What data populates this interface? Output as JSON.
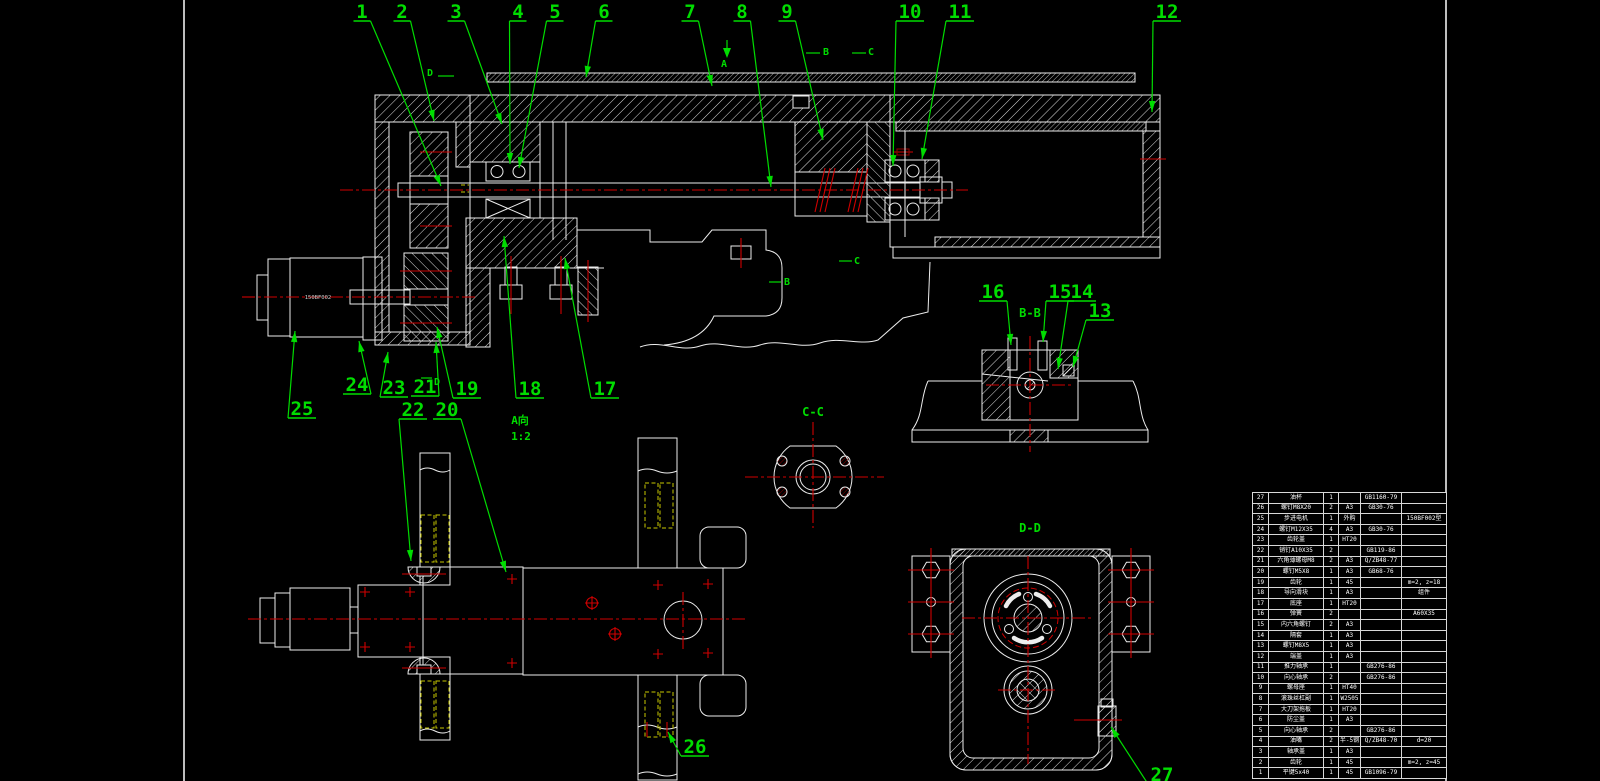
{
  "colors": {
    "background": "#000000",
    "line_white": "#ededed",
    "callout_green": "#00dd00",
    "centerline_red": "#cf0000",
    "hole_red": "#8a0000",
    "hidden_yellow": "#c9c900"
  },
  "drawing": {
    "motor_label": "150BF002",
    "view_labels": [
      {
        "id": "a-view",
        "text": "A向"
      },
      {
        "id": "a-view-scale",
        "text": "1:2"
      },
      {
        "id": "section-bb",
        "text": "B-B"
      },
      {
        "id": "section-cc",
        "text": "C-C"
      },
      {
        "id": "section-dd",
        "text": "D-D"
      }
    ],
    "section_markers": [
      {
        "text": "D"
      },
      {
        "text": "A"
      },
      {
        "text": "B"
      },
      {
        "text": "C"
      },
      {
        "text": "B"
      },
      {
        "text": "C"
      },
      {
        "text": "D"
      }
    ],
    "callouts": [
      {
        "n": "1",
        "x": 362,
        "y": 11,
        "tx": 441,
        "ty": 186
      },
      {
        "n": "2",
        "x": 402,
        "y": 11,
        "tx": 434,
        "ty": 121
      },
      {
        "n": "3",
        "x": 456,
        "y": 11,
        "tx": 502,
        "ty": 124
      },
      {
        "n": "4",
        "x": 518,
        "y": 11,
        "tx": 510,
        "ty": 164
      },
      {
        "n": "5",
        "x": 555,
        "y": 11,
        "tx": 519,
        "ty": 168
      },
      {
        "n": "6",
        "x": 604,
        "y": 11,
        "tx": 586,
        "ty": 77
      },
      {
        "n": "7",
        "x": 690,
        "y": 11,
        "tx": 712,
        "ty": 86
      },
      {
        "n": "8",
        "x": 742,
        "y": 11,
        "tx": 771,
        "ty": 187
      },
      {
        "n": "9",
        "x": 787,
        "y": 11,
        "tx": 823,
        "ty": 140
      },
      {
        "n": "10",
        "x": 910,
        "y": 11,
        "tx": 893,
        "ty": 166
      },
      {
        "n": "11",
        "x": 960,
        "y": 11,
        "tx": 922,
        "ty": 159
      },
      {
        "n": "12",
        "x": 1167,
        "y": 11,
        "tx": 1152,
        "ty": 112
      },
      {
        "n": "13",
        "x": 1100,
        "y": 310,
        "tx": 1073,
        "ty": 367
      },
      {
        "n": "14",
        "x": 1082,
        "y": 291,
        "tx": 1058,
        "ty": 369
      },
      {
        "n": "15",
        "x": 1060,
        "y": 291,
        "tx": 1043,
        "ty": 342
      },
      {
        "n": "16",
        "x": 993,
        "y": 291,
        "tx": 1011,
        "ty": 345
      },
      {
        "n": "17",
        "x": 605,
        "y": 388,
        "tx": 565,
        "ty": 258
      },
      {
        "n": "18",
        "x": 530,
        "y": 388,
        "tx": 504,
        "ty": 236
      },
      {
        "n": "19",
        "x": 467,
        "y": 388,
        "tx": 437,
        "ty": 327
      },
      {
        "n": "20",
        "x": 447,
        "y": 409,
        "tx": 506,
        "ty": 572
      },
      {
        "n": "21",
        "x": 425,
        "y": 386,
        "tx": 436,
        "ty": 342
      },
      {
        "n": "22",
        "x": 413,
        "y": 409,
        "tx": 411,
        "ty": 561
      },
      {
        "n": "23",
        "x": 394,
        "y": 387,
        "tx": 388,
        "ty": 352
      },
      {
        "n": "24",
        "x": 357,
        "y": 384,
        "tx": 359,
        "ty": 341
      },
      {
        "n": "25",
        "x": 302,
        "y": 408,
        "tx": 295,
        "ty": 331
      },
      {
        "n": "26",
        "x": 695,
        "y": 746,
        "tx": 668,
        "ty": 732
      },
      {
        "n": "27",
        "x": 1162,
        "y": 774,
        "tx": 1111,
        "ty": 727
      }
    ]
  },
  "parts_table": {
    "rows": [
      {
        "no": "27",
        "name": "油杯",
        "qty": "1",
        "mat": "",
        "std": "GB1160-79",
        "rem": ""
      },
      {
        "no": "26",
        "name": "螺钉M8X20",
        "qty": "2",
        "mat": "A3",
        "std": "GB30-76",
        "rem": ""
      },
      {
        "no": "25",
        "name": "步进电机",
        "qty": "1",
        "mat": "外购",
        "std": "",
        "rem": "150BF002型"
      },
      {
        "no": "24",
        "name": "螺钉M12X35",
        "qty": "4",
        "mat": "A3",
        "std": "GB30-76",
        "rem": ""
      },
      {
        "no": "23",
        "name": "齿轮盖",
        "qty": "1",
        "mat": "HT20",
        "std": "",
        "rem": ""
      },
      {
        "no": "22",
        "name": "销钉A10X35",
        "qty": "2",
        "mat": "",
        "std": "GB119-86",
        "rem": ""
      },
      {
        "no": "21",
        "name": "六角薄螺母M8",
        "qty": "2",
        "mat": "A3",
        "std": "Q/ZB48-77",
        "rem": ""
      },
      {
        "no": "20",
        "name": "螺钉M5X8",
        "qty": "1",
        "mat": "A3",
        "std": "GB68-76",
        "rem": ""
      },
      {
        "no": "19",
        "name": "齿轮",
        "qty": "1",
        "mat": "45",
        "std": "",
        "rem": "m=2, z=18"
      },
      {
        "no": "18",
        "name": "导向滑块",
        "qty": "1",
        "mat": "A3",
        "std": "",
        "rem": "组件"
      },
      {
        "no": "17",
        "name": "底座",
        "qty": "1",
        "mat": "HT20",
        "std": "",
        "rem": ""
      },
      {
        "no": "16",
        "name": "弹簧",
        "qty": "2",
        "mat": "",
        "std": "",
        "rem": "A60X35"
      },
      {
        "no": "15",
        "name": "内六角螺钉",
        "qty": "2",
        "mat": "A3",
        "std": "",
        "rem": ""
      },
      {
        "no": "14",
        "name": "隔套",
        "qty": "1",
        "mat": "A3",
        "std": "",
        "rem": ""
      },
      {
        "no": "13",
        "name": "螺钉M8X5",
        "qty": "1",
        "mat": "A3",
        "std": "",
        "rem": ""
      },
      {
        "no": "12",
        "name": "端盖",
        "qty": "1",
        "mat": "A3",
        "std": "",
        "rem": ""
      },
      {
        "no": "11",
        "name": "推力轴承",
        "qty": "1",
        "mat": "",
        "std": "GB276-86",
        "rem": ""
      },
      {
        "no": "10",
        "name": "向心轴承",
        "qty": "2",
        "mat": "",
        "std": "GB276-86",
        "rem": ""
      },
      {
        "no": "9",
        "name": "螺母座",
        "qty": "1",
        "mat": "HT40",
        "std": "",
        "rem": ""
      },
      {
        "no": "8",
        "name": "滚珠丝杠副",
        "qty": "1",
        "mat": "W2505",
        "std": "",
        "rem": ""
      },
      {
        "no": "7",
        "name": "大刀架拖板",
        "qty": "1",
        "mat": "HT20",
        "std": "",
        "rem": ""
      },
      {
        "no": "6",
        "name": "防尘盖",
        "qty": "1",
        "mat": "A3",
        "std": "",
        "rem": ""
      },
      {
        "no": "5",
        "name": "向心轴承",
        "qty": "2",
        "mat": "",
        "std": "GB276-86",
        "rem": ""
      },
      {
        "no": "4",
        "name": "油嘴",
        "qty": "2",
        "mat": "半-5钢",
        "std": "Q/ZB48-70",
        "rem": "d=20"
      },
      {
        "no": "3",
        "name": "轴承盖",
        "qty": "1",
        "mat": "A3",
        "std": "",
        "rem": ""
      },
      {
        "no": "2",
        "name": "齿轮",
        "qty": "1",
        "mat": "45",
        "std": "",
        "rem": "m=2, z=45"
      },
      {
        "no": "1",
        "name": "平键5x40",
        "qty": "1",
        "mat": "45",
        "std": "GB1096-79",
        "rem": ""
      }
    ]
  }
}
